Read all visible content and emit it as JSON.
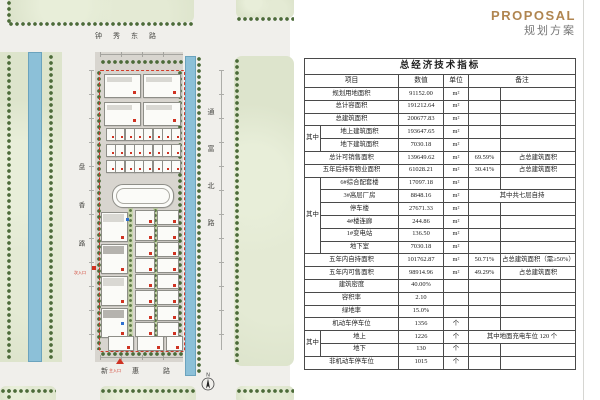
{
  "header": {
    "title_en": "PROPOSAL",
    "title_zh": "规划方案"
  },
  "plan": {
    "road_north": "钟秀东路",
    "road_east": "通富北路",
    "road_west": "盘香路",
    "road_south": "新惠路",
    "entrance_main": "主入口",
    "entrance_side": "次入口",
    "north_label": "N"
  },
  "table": {
    "title": "总经济技术指标",
    "headers": {
      "item": "项目",
      "value": "数值",
      "unit": "单位",
      "note": "备注"
    },
    "group_label": "其中",
    "rows": [
      {
        "item": "规划用地面积",
        "value": "91152.00",
        "unit": "m²",
        "pct": "",
        "note": ""
      },
      {
        "item": "总计容面积",
        "value": "191212.64",
        "unit": "m²",
        "pct": "",
        "note": ""
      },
      {
        "item": "总建筑面积",
        "value": "200677.83",
        "unit": "m²",
        "pct": "",
        "note": ""
      },
      {
        "group": "start",
        "gspan": 2,
        "item": "地上建筑面积",
        "value": "193647.65",
        "unit": "m²",
        "pct": "",
        "note": ""
      },
      {
        "group": "cont",
        "item": "地下建筑面积",
        "value": "7030.18",
        "unit": "m²",
        "pct": "",
        "note": ""
      },
      {
        "item": "总计可销售面积",
        "value": "139649.62",
        "unit": "m²",
        "pct": "69.59%",
        "note": "占总建筑面积"
      },
      {
        "item": "五年后持有物业面积",
        "value": "61028.21",
        "unit": "m²",
        "pct": "30.41%",
        "note": "占总建筑面积"
      },
      {
        "group": "start",
        "gspan": 6,
        "item": "6#综合配套楼",
        "value": "17097.18",
        "unit": "m²",
        "pct": "",
        "note": ""
      },
      {
        "group": "cont",
        "item": "3#高层厂房",
        "value": "8848.16",
        "unit": "m²",
        "note_span": true,
        "note": "其中共七层自持"
      },
      {
        "group": "cont",
        "item": "停车楼",
        "value": "27671.33",
        "unit": "m²",
        "pct": "",
        "note": ""
      },
      {
        "group": "cont",
        "item": "4#楼连廊",
        "value": "244.86",
        "unit": "m²",
        "pct": "",
        "note": ""
      },
      {
        "group": "cont",
        "item": "1#变电站",
        "value": "136.50",
        "unit": "m²",
        "pct": "",
        "note": ""
      },
      {
        "group": "cont",
        "item": "地下室",
        "value": "7030.18",
        "unit": "m²",
        "pct": "",
        "note": ""
      },
      {
        "item": "五年内自持面积",
        "value": "101762.87",
        "unit": "m²",
        "pct": "50.71%",
        "note": "占总建筑面积（需≥50%）"
      },
      {
        "item": "五年内可售面积",
        "value": "98914.96",
        "unit": "m²",
        "pct": "49.29%",
        "note": "占总建筑面积"
      },
      {
        "item": "建筑密度",
        "value": "40.00%",
        "unit": "",
        "pct": "",
        "note": ""
      },
      {
        "item": "容积率",
        "value": "2.10",
        "unit": "",
        "pct": "",
        "note": ""
      },
      {
        "item": "绿地率",
        "value": "15.0%",
        "unit": "",
        "pct": "",
        "note": ""
      },
      {
        "item": "机动车停车位",
        "value": "1356",
        "unit": "个",
        "pct": "",
        "note": ""
      },
      {
        "group": "start",
        "gspan": 2,
        "item": "地上",
        "value": "1226",
        "unit": "个",
        "note_span": true,
        "note": "其中地面充电车位 120 个"
      },
      {
        "group": "cont",
        "item": "地下",
        "value": "130",
        "unit": "个",
        "pct": "",
        "note": ""
      },
      {
        "item": "非机动车停车位",
        "value": "1015",
        "unit": "个",
        "pct": "",
        "note": ""
      }
    ]
  },
  "colors": {
    "accent_red": "#cf3222",
    "title_bronze": "#b08550",
    "canal_blue": "#8cc0d8",
    "boundary_red": "#d23b2a"
  }
}
